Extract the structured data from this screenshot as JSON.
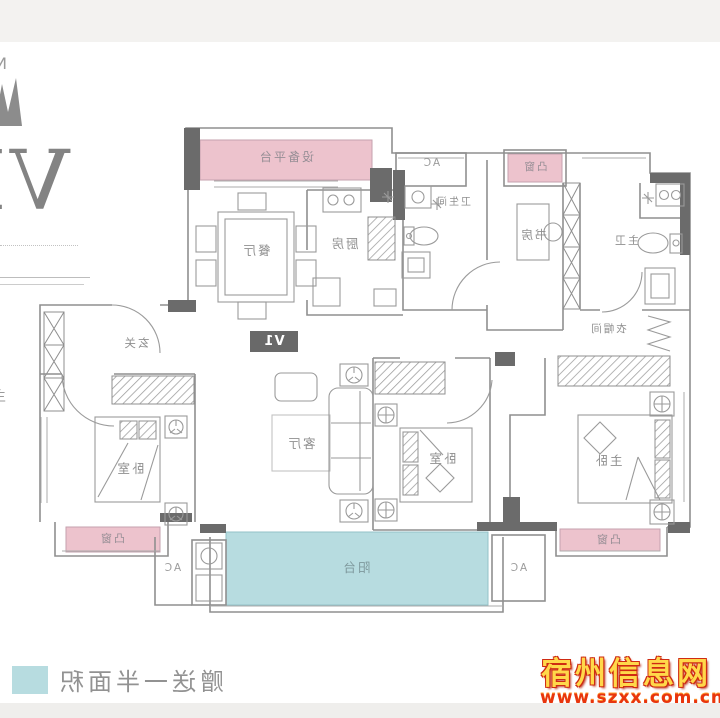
{
  "logo": {
    "letter": "N",
    "numeral": "VI",
    "edge_fragment": "主"
  },
  "plan": {
    "badge": "V1",
    "rooms": {
      "platform": "设备平台",
      "dining": "餐厅",
      "kitchen": "厨房",
      "bathroom": "卫生间",
      "study": "书房",
      "master_bath": "主卫",
      "cloakroom": "衣帽间",
      "entry": "玄关",
      "living": "客厅",
      "bedroom_left": "卧室",
      "bedroom_mid": "卧室",
      "master_bedroom": "主卧",
      "balcony": "阳台"
    },
    "bay_windows": {
      "top": "凸窗",
      "bottom_left": "凸窗",
      "bottom_right": "凸窗"
    },
    "ac": {
      "top": "AC",
      "bottom_left": "AC",
      "bottom_right": "AC"
    }
  },
  "legend": {
    "text": "赠送一半面积",
    "swatch_color": "#b7dce0"
  },
  "watermark": {
    "site": "宿州信息网",
    "url": "www.szxx.com.cn"
  },
  "colors": {
    "bay_window": "#edc3cd",
    "balcony": "#b7dce0",
    "wall": "#8f8f8f",
    "wall_dark": "#6b6b6b",
    "label": "#8f8f8f",
    "badge_bg": "#696969",
    "top_strip": "#f3f2f0",
    "bottom_strip": "#efeeec"
  },
  "note_mirrored": true
}
